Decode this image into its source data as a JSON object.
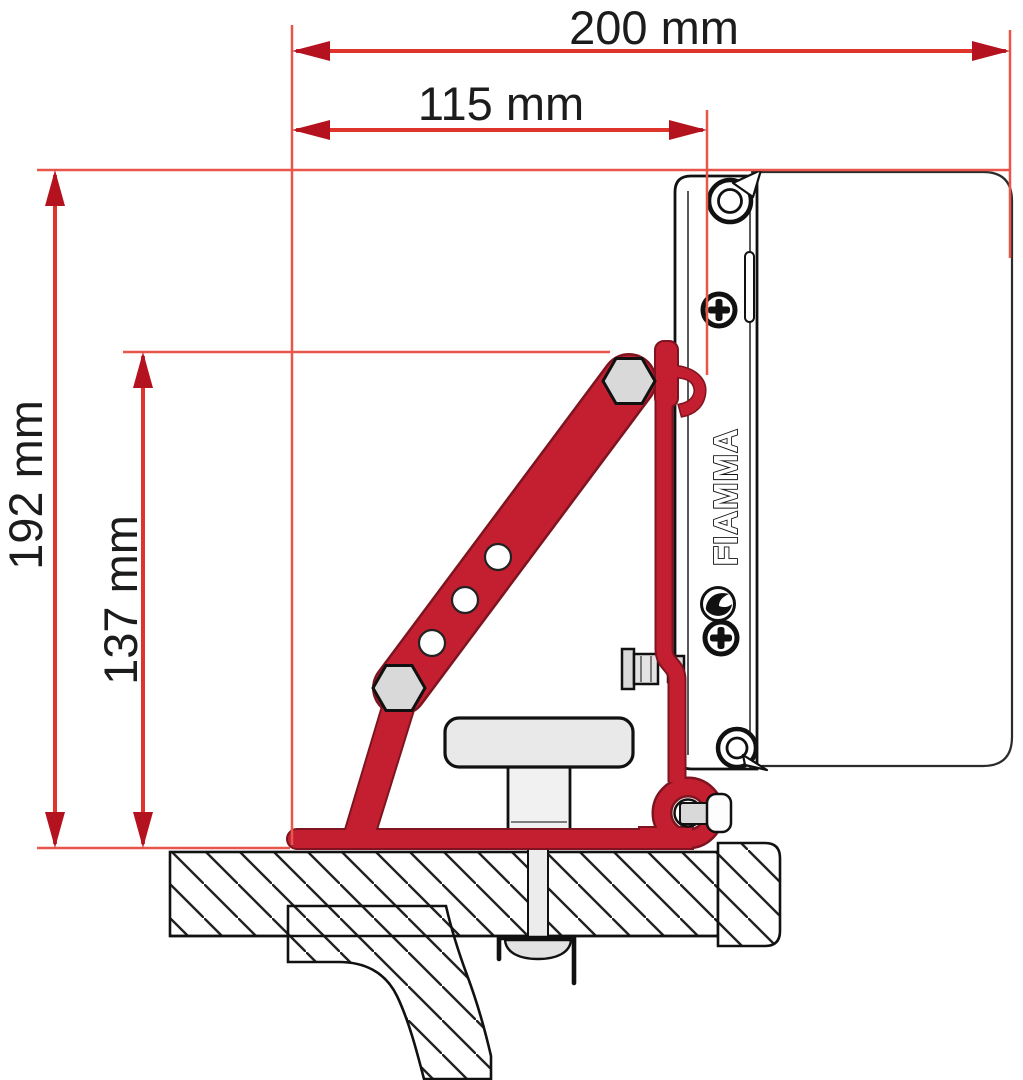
{
  "diagram": {
    "brand_label": "FIAMMA",
    "dimensions": {
      "top_width": "200 mm",
      "inner_width": "115 mm",
      "total_height": "192 mm",
      "bracket_height": "137 mm"
    },
    "colors": {
      "dimension_line_red": "#df342b",
      "extension_line_red": "#e8564a",
      "arrow_red": "#b5121f",
      "bracket_red": "#c41f30",
      "bracket_outline_dark": "#7e1420",
      "outline_black": "#111111",
      "metal_gray": "#d9d9d9",
      "background": "#ffffff"
    }
  }
}
